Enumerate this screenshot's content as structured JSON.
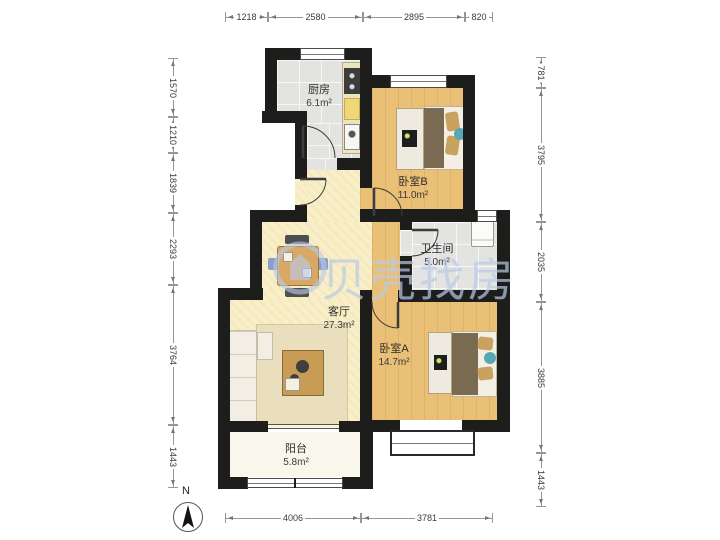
{
  "plan": {
    "watermark_text": "贝壳找房",
    "compass_label": "N",
    "rooms": {
      "kitchen": {
        "name": "厨房",
        "area": "6.1m²"
      },
      "bedroom_b": {
        "name": "卧室B",
        "area": "11.0m²"
      },
      "bathroom": {
        "name": "卫生间",
        "area": "5.0m²"
      },
      "living": {
        "name": "客厅",
        "area": "27.3m²"
      },
      "bedroom_a": {
        "name": "卧室A",
        "area": "14.7m²"
      },
      "balcony": {
        "name": "阳台",
        "area": "5.8m²"
      }
    },
    "dimensions": {
      "top": [
        "1218",
        "2580",
        "2895",
        "820"
      ],
      "bottom": [
        "4006",
        "3781"
      ],
      "left": [
        "1570",
        "1210",
        "1839",
        "2293",
        "3764",
        "1443"
      ],
      "right": [
        "781",
        "3795",
        "2035",
        "3885",
        "1443"
      ]
    },
    "colors": {
      "wall": "#1d1d1b",
      "wood_floor": "#eabf76",
      "living_floor": "#f8efc9",
      "tile_floor": "#e3e3e1",
      "balcony_floor": "#f9f7ec",
      "watermark": "#b9cbe8",
      "teal_accent": "#57a8b5",
      "furniture_wood": "#d9a865"
    }
  }
}
